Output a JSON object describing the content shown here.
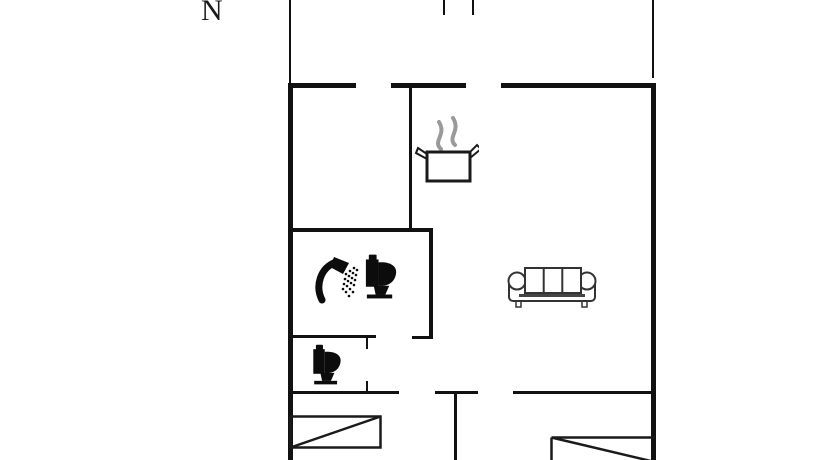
{
  "compass": {
    "label": "N"
  },
  "colors": {
    "wall": "#111111",
    "furniture_outline": "#1a1a1a",
    "furniture_fill": "#0c0c0c",
    "steam": "#9a9a9a",
    "background": "#ffffff"
  },
  "floorplan": {
    "walls": [
      {
        "name": "left-wall-upper-thin",
        "x": 289,
        "y": 0,
        "w": 2,
        "h": 84
      },
      {
        "name": "top-stub-left",
        "x": 443,
        "y": 0,
        "w": 2,
        "h": 15
      },
      {
        "name": "top-stub-right",
        "x": 472,
        "y": 0,
        "w": 2,
        "h": 15
      },
      {
        "name": "right-wall-upper-thin",
        "x": 652,
        "y": 0,
        "w": 2,
        "h": 78
      },
      {
        "name": "top-wall-seg-1",
        "x": 288,
        "y": 83,
        "w": 68,
        "h": 5
      },
      {
        "name": "top-wall-seg-2",
        "x": 391,
        "y": 83,
        "w": 75,
        "h": 5
      },
      {
        "name": "top-wall-seg-3",
        "x": 501,
        "y": 83,
        "w": 155,
        "h": 5
      },
      {
        "name": "left-wall",
        "x": 288,
        "y": 83,
        "w": 5,
        "h": 377
      },
      {
        "name": "right-wall",
        "x": 651,
        "y": 83,
        "w": 5,
        "h": 377
      },
      {
        "name": "kitchen-partition-wall",
        "x": 409,
        "y": 88,
        "w": 3,
        "h": 142
      },
      {
        "name": "bathroom-top-wall",
        "x": 288,
        "y": 228,
        "w": 145,
        "h": 4
      },
      {
        "name": "bathroom-right-wall",
        "x": 429,
        "y": 228,
        "w": 4,
        "h": 111
      },
      {
        "name": "bathroom-bottom-wall-left",
        "x": 288,
        "y": 335,
        "w": 88,
        "h": 3
      },
      {
        "name": "bathroom-bottom-wall-right",
        "x": 412,
        "y": 336,
        "w": 21,
        "h": 3
      },
      {
        "name": "wc-door-jamb-top",
        "x": 366,
        "y": 338,
        "w": 2,
        "h": 11
      },
      {
        "name": "wc-door-jamb-bottom",
        "x": 366,
        "y": 381,
        "w": 2,
        "h": 10
      },
      {
        "name": "hall-wall-seg-1",
        "x": 288,
        "y": 391,
        "w": 111,
        "h": 3
      },
      {
        "name": "hall-wall-seg-2",
        "x": 435,
        "y": 391,
        "w": 43,
        "h": 3
      },
      {
        "name": "hall-wall-seg-3",
        "x": 513,
        "y": 391,
        "w": 140,
        "h": 3
      },
      {
        "name": "bedroom-divider-wall",
        "x": 454,
        "y": 394,
        "w": 3,
        "h": 66
      }
    ],
    "rooms": [
      {
        "name": "kitchen-area",
        "x": 293,
        "y": 88,
        "w": 116,
        "h": 140
      },
      {
        "name": "living-room-area",
        "x": 433,
        "y": 88,
        "w": 218,
        "h": 303
      },
      {
        "name": "bathroom-area",
        "x": 293,
        "y": 232,
        "w": 136,
        "h": 103
      },
      {
        "name": "wc-area",
        "x": 293,
        "y": 338,
        "w": 73,
        "h": 53
      },
      {
        "name": "bedroom-left-area",
        "x": 293,
        "y": 394,
        "w": 161,
        "h": 66
      },
      {
        "name": "bedroom-right-area",
        "x": 457,
        "y": 394,
        "w": 194,
        "h": 66
      }
    ],
    "furniture": [
      {
        "name": "stove-pot",
        "x": 413,
        "y": 112,
        "w": 66,
        "h": 72
      },
      {
        "name": "shower",
        "x": 312,
        "y": 254,
        "w": 50,
        "h": 50
      },
      {
        "name": "toilet-bathroom",
        "x": 362,
        "y": 252,
        "w": 37,
        "h": 50
      },
      {
        "name": "toilet-wc",
        "x": 308,
        "y": 343,
        "w": 37,
        "h": 44
      },
      {
        "name": "sofa",
        "x": 506,
        "y": 264,
        "w": 92,
        "h": 45
      },
      {
        "name": "bed-left",
        "x": 289,
        "y": 415,
        "w": 93,
        "h": 34
      },
      {
        "name": "bed-right",
        "x": 550,
        "y": 436,
        "w": 105,
        "h": 24
      }
    ]
  }
}
